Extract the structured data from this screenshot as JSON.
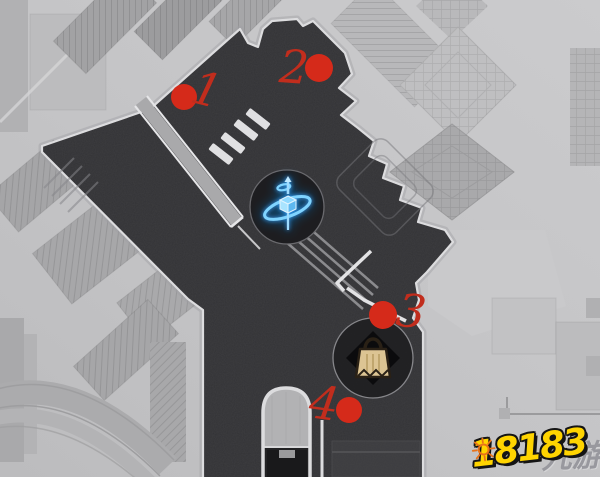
{
  "map": {
    "name": "area-map",
    "background_color": "#c5c5c7",
    "explored_area_color": "#323235",
    "border_color": "#dcdcde"
  },
  "markers": [
    {
      "label": "1",
      "dot_x": 184,
      "dot_y": 97,
      "num_x": 203,
      "num_y": 105,
      "dot_color": "#d52a1a",
      "num_color": "#c12d1d"
    },
    {
      "label": "2",
      "dot_x": 319,
      "dot_y": 68,
      "num_x": 293,
      "num_y": 83,
      "dot_color": "#d52a1a",
      "num_color": "#c12d1d"
    },
    {
      "label": "3",
      "dot_x": 383,
      "dot_y": 315,
      "num_x": 409,
      "num_y": 327,
      "dot_color": "#d52a1a",
      "num_color": "#c12d1d"
    },
    {
      "label": "4",
      "dot_x": 349,
      "dot_y": 410,
      "num_x": 322,
      "num_y": 419,
      "dot_color": "#d52a1a",
      "num_color": "#c12d1d"
    }
  ],
  "icons": [
    {
      "name": "space-anchor",
      "meaning": "teleport point",
      "glow_color": "#5ec1ff"
    },
    {
      "name": "shop-bag",
      "meaning": "vendor / shop",
      "bag_color": "#dcc493"
    }
  ],
  "watermark": {
    "logo_text": "18183",
    "site_text": "九游",
    "logo_color": "#ffd400",
    "sun_color": "#e8731a"
  }
}
